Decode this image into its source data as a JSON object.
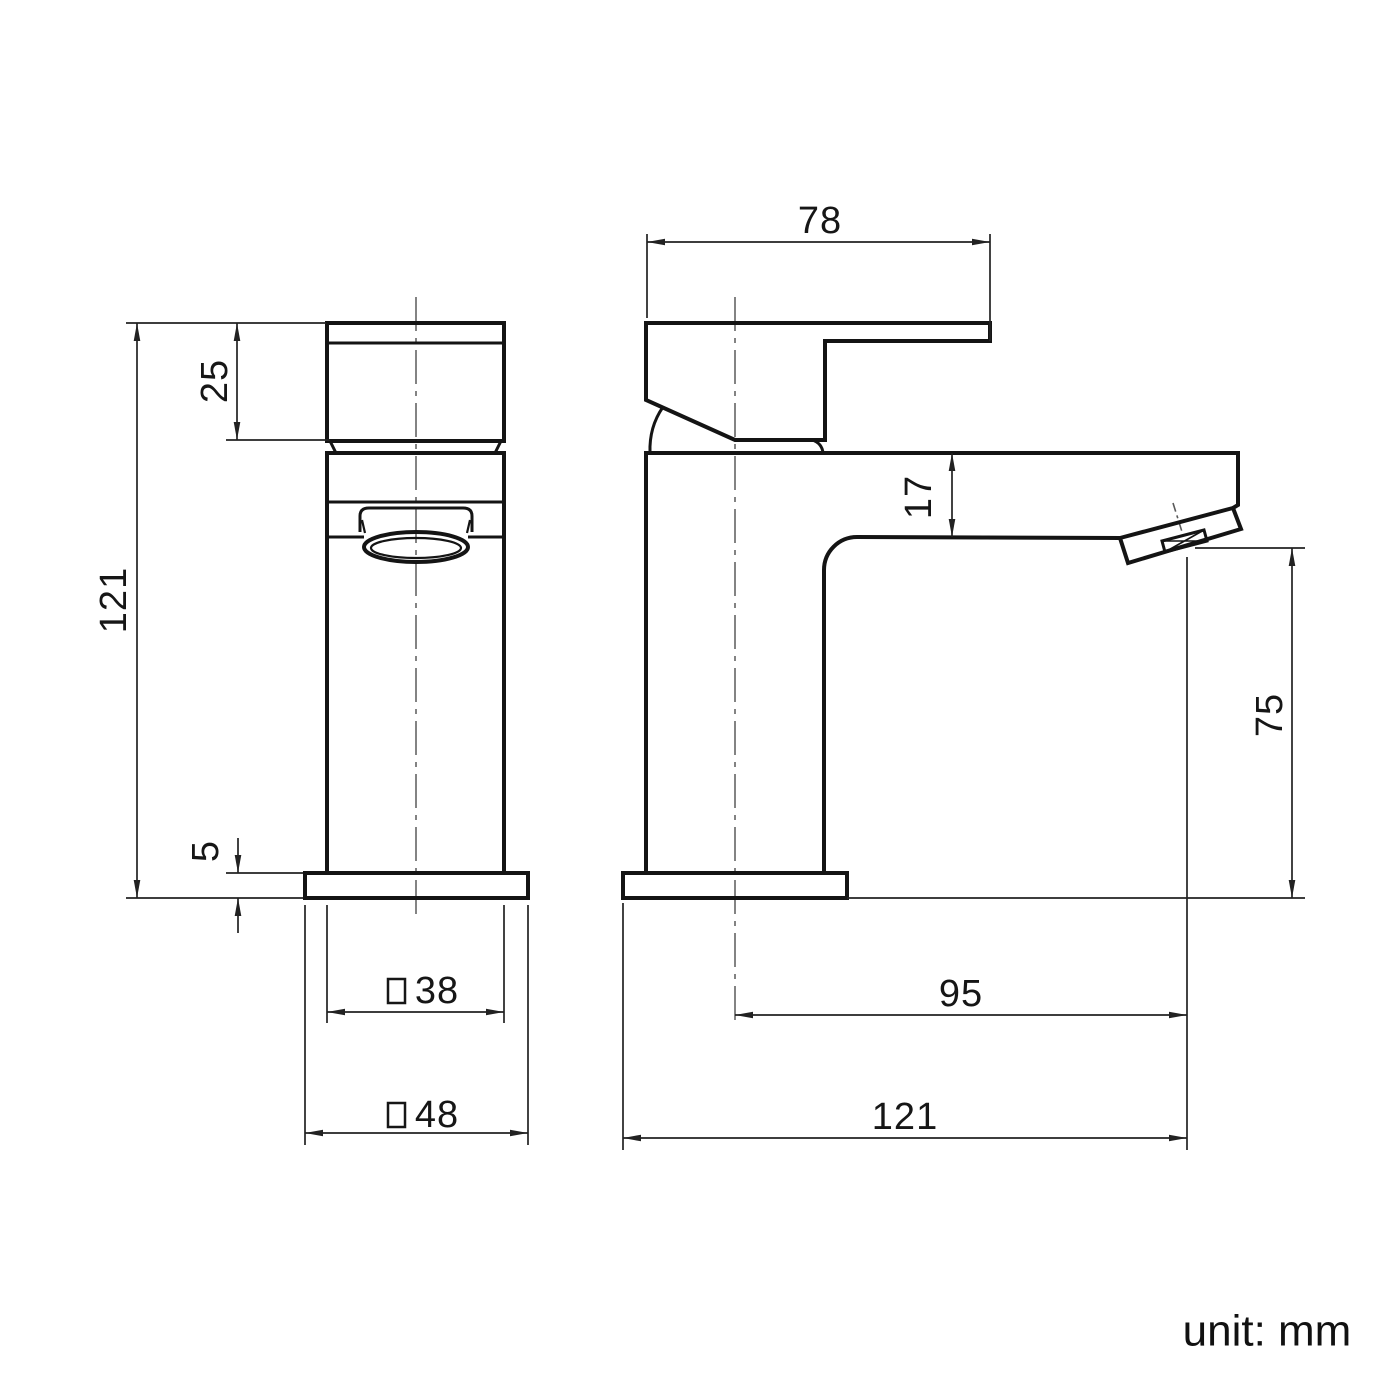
{
  "drawing": {
    "type": "technical-dimension-drawing",
    "subject": "basin tap (mono mixer faucet), front and side orthographic views",
    "unit_note": "unit: mm",
    "colors": {
      "background": "#ffffff",
      "part_line": "#141414",
      "dimension_line": "#222222",
      "centerline": "#7d7d7d",
      "text": "#161616"
    },
    "symbols": {
      "square_section": "□"
    }
  },
  "dims": {
    "front_total_height": "121",
    "front_handle_height": "25",
    "front_base_height": "5",
    "front_body_width": "38",
    "front_base_width": "48",
    "side_handle_length": "78",
    "side_spout_thickness": "17",
    "side_outlet_height": "75",
    "side_spout_reach": "95",
    "side_total_length": "121",
    "unit_note": "unit: mm"
  }
}
